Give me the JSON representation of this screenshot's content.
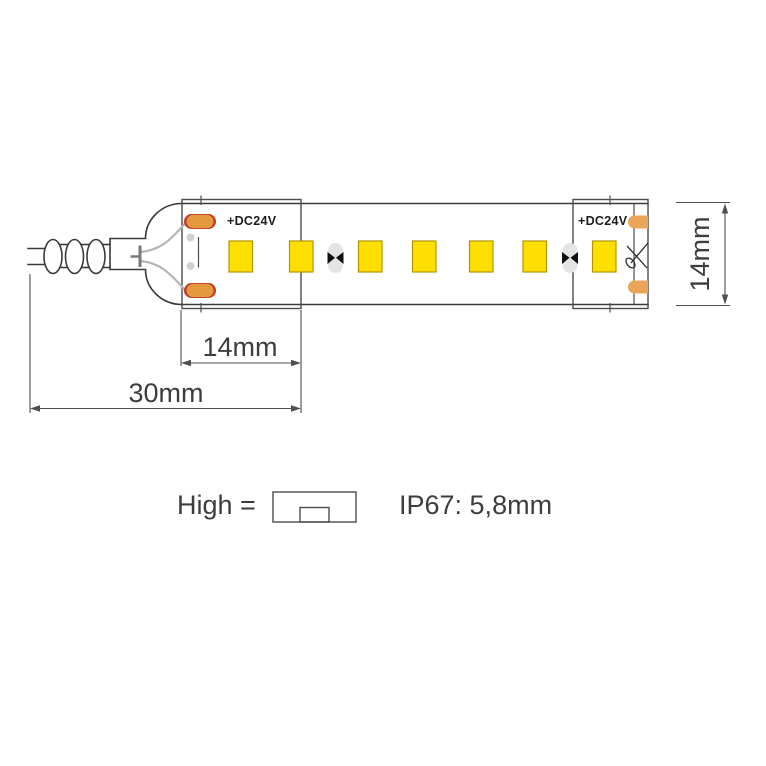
{
  "diagram": {
    "title": "led-strip-dimension-drawing",
    "labels": {
      "dc24v_left": "+DC24V",
      "dc24v_right": "+DC24V"
    },
    "dimensions": {
      "section_width": "14mm",
      "total_width": "30mm",
      "strip_height": "14mm"
    },
    "legend": {
      "high_label": "High =",
      "ip_rating": "IP67: 5,8mm"
    },
    "strip": {
      "led_count": 7,
      "cut_point_count": 2,
      "solder_pad_pairs": 2
    },
    "icons": {
      "scissors": "scissors-icon",
      "cut_point": "cut-point-icon",
      "profile_cross_section": "profile-icon"
    },
    "colors": {
      "led": "#ffdf00",
      "ledBorder": "#b19500",
      "pad": "#e5993f",
      "padStroke": "#c23b27",
      "padRight": "#eaa55a",
      "wire": "#b5b5b5",
      "outline": "#3a3a3a",
      "dim": "#4f4f4f",
      "text": "#3d3d3d",
      "cutBg": "#e4e4e4",
      "cutMark": "#101010",
      "dot": "#d2d2d2"
    }
  }
}
